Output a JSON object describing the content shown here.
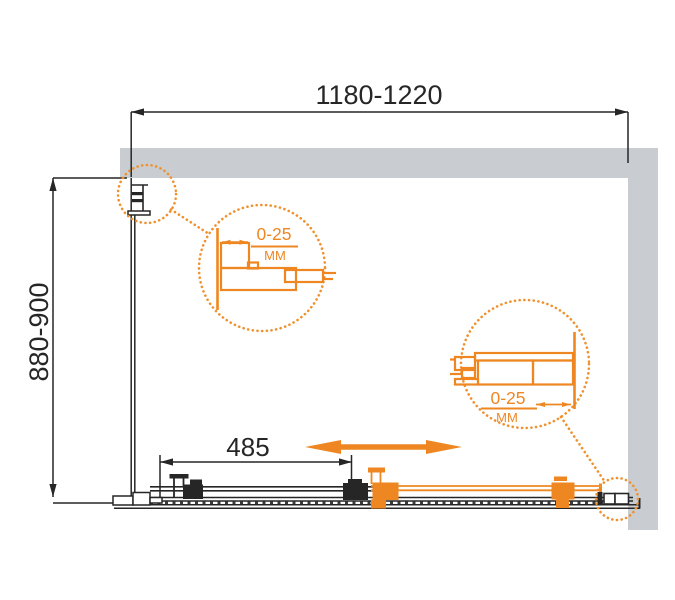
{
  "drawing": {
    "title": "shower-enclosure-dimension-drawing",
    "width_dim": "1180-1220",
    "depth_dim": "880-900",
    "panel_dim": "485",
    "detail_left": {
      "range": "0-25",
      "unit": "MM"
    },
    "detail_right": {
      "range": "0-25",
      "unit": "MM"
    },
    "colors": {
      "accent_orange": "#EE8722",
      "callout_orange": "#F0912E",
      "wall_gray": "#C9CDD1",
      "line_black": "#262626"
    }
  }
}
